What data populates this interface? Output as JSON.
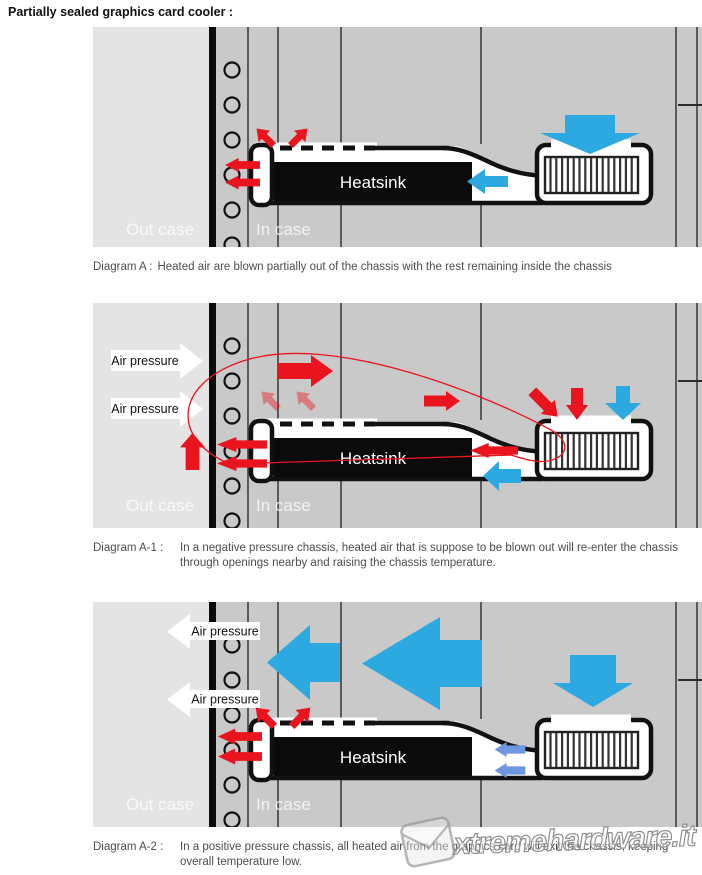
{
  "title": "Partially sealed graphics card cooler :",
  "labels": {
    "heatsink": "Heatsink",
    "out_case": "Out case",
    "in_case": "In case",
    "air_pressure": "Air pressure"
  },
  "captions": {
    "a_label": "Diagram A :",
    "a_text": "Heated air are blown partially out of the chassis with the rest remaining inside the chassis",
    "a1_label": "Diagram A-1 :",
    "a1_text": "In a negative pressure chassis, heated air that is suppose to be blown out will re-enter the chassis through openings nearby and raising the chassis temperature.",
    "a2_label": "Diagram A-2 :",
    "a2_text": "In a positive pressure chassis, all heated air from the graphics card will exit the chassis, keeping overall temperature low."
  },
  "watermark": {
    "text": "xtremehardware.it"
  },
  "colors": {
    "red": "#E9141D",
    "blue": "#2BA9E0",
    "light_blue": "#6C95E2",
    "case_inner": "#C9C9C9",
    "case_outer": "#E4E4E4",
    "caption_text": "#4D4D4D"
  }
}
